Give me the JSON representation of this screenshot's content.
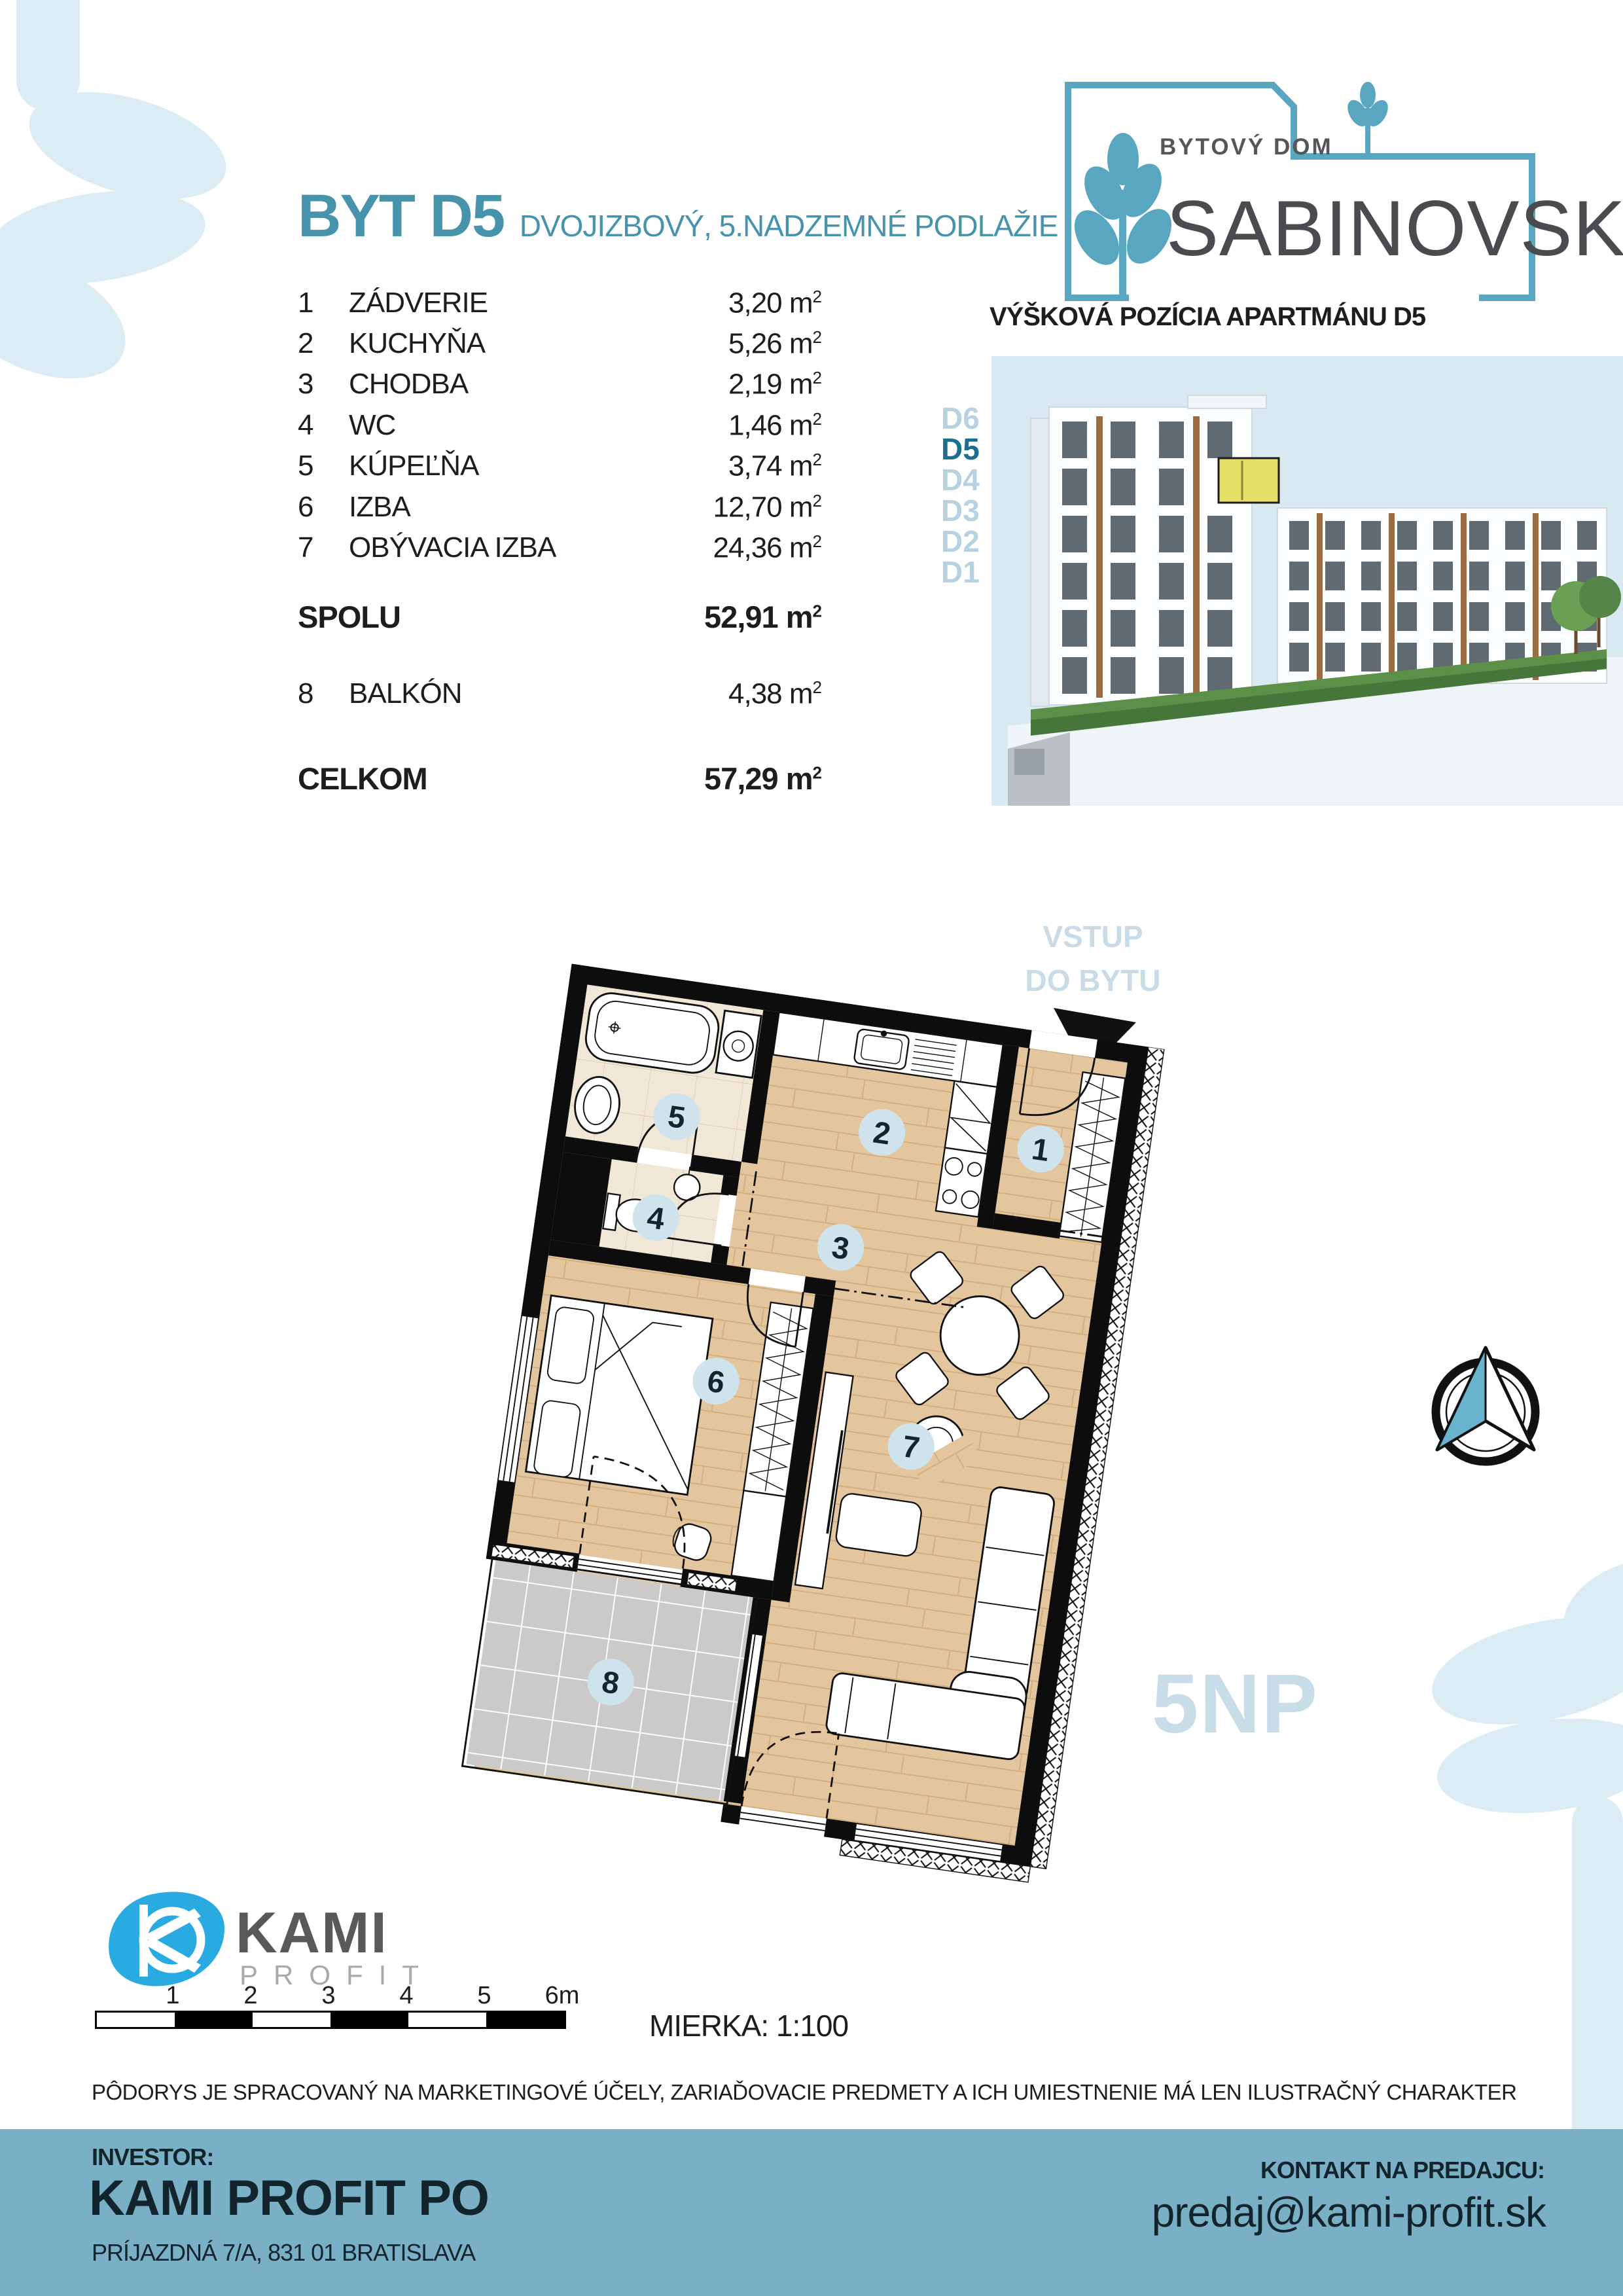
{
  "logo": {
    "line1": "BYTOVÝ DOM",
    "line2": "SABINOVSKÁ"
  },
  "header": {
    "title": "BYT D5",
    "subtitle": "DVOJIZBOVÝ, 5.NADZEMNÉ PODLAŽIE"
  },
  "room_table": {
    "unit": "m",
    "sup": "2",
    "rows": [
      {
        "num": "1",
        "name": "ZÁDVERIE",
        "area": "3,20"
      },
      {
        "num": "2",
        "name": "KUCHYŇA",
        "area": "5,26"
      },
      {
        "num": "3",
        "name": "CHODBA",
        "area": "2,19"
      },
      {
        "num": "4",
        "name": "WC",
        "area": "1,46"
      },
      {
        "num": "5",
        "name": "KÚPEĽŇA",
        "area": "3,74"
      },
      {
        "num": "6",
        "name": "IZBA",
        "area": "12,70"
      },
      {
        "num": "7",
        "name": "OBÝVACIA IZBA",
        "area": "24,36"
      }
    ],
    "total_label": "SPOLU",
    "total_area": "52,91",
    "balcony": {
      "num": "8",
      "name": "BALKÓN",
      "area": "4,38"
    },
    "grand_label": "CELKOM",
    "grand_area": "57,29"
  },
  "render": {
    "title": "VÝŠKOVÁ POZÍCIA APARTMÁNU D5",
    "floors": [
      "D6",
      "D5",
      "D4",
      "D3",
      "D2",
      "D1"
    ],
    "highlighted": "D5"
  },
  "plan": {
    "entry_line1": "VSTUP",
    "entry_line2": "DO BYTU",
    "floor_tag": "5NP",
    "rooms": [
      "1",
      "2",
      "3",
      "4",
      "5",
      "6",
      "7",
      "8"
    ]
  },
  "scalebar": {
    "labels": [
      "1",
      "2",
      "3",
      "4",
      "5",
      "6m"
    ],
    "scale_text": "MIERKA: 1:100"
  },
  "disclaimer": "PÔDORYS JE SPRACOVANÝ NA MARKETINGOVÉ ÚČELY, ZARIAĎOVACIE PREDMETY A ICH UMIESTNENIE MÁ LEN ILUSTRAČNÝ CHARAKTER",
  "footer": {
    "investor_label": "INVESTOR:",
    "company": "KAMI PROFIT PO",
    "address": "PRÍJAZDNÁ 7/A, 831 01 BRATISLAVA",
    "contact_label": "KONTAKT NA PREDAJCU:",
    "email": "predaj@kami-profit.sk"
  },
  "brand": {
    "name": "KAMI",
    "sub": "PROFIT"
  },
  "colors": {
    "teal": "#4793ac",
    "footer": "#79b0c5",
    "accent_dark": "#1c6f93",
    "pale_label": "#c9dde9",
    "circle": "#cfe3ed",
    "wood": "#e4c69e",
    "sky": "#d9e9f2",
    "kami_blue": "#29abe2",
    "highlight_unit": "#e6df66"
  }
}
